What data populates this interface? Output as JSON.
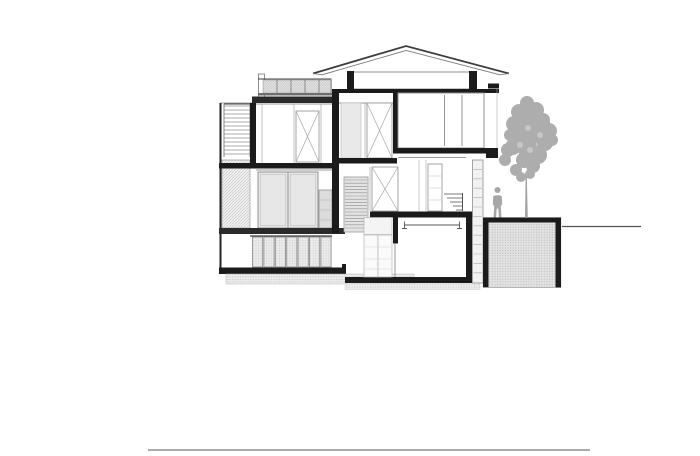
{
  "page": {
    "background": "#ffffff"
  },
  "colors": {
    "paper": "#ffffff",
    "ink": "#1b1b1b",
    "slab": "#2a2a2a",
    "dark": "#3d3d3d",
    "mid": "#7a7a7a",
    "light": "#a9a9a9",
    "frame": "#8f8f8f",
    "panel": "#e7e7e7",
    "panel-light": "#f2f2f2",
    "hatch-bg": "#ededed",
    "hatch-line": "#c3c3c3",
    "ground-bg": "#e2e2e2",
    "ground-dot": "#b7b7b7",
    "silhouette": "#a7a7a7",
    "ground-line": "#555555",
    "rule": "#8f8f8f"
  },
  "drawing": {
    "type": "architectural-section",
    "elements": [
      "hipped-roof",
      "clerestory-band",
      "roof-terrace-railing",
      "terrace-slab",
      "external-stair",
      "stair-balustrade-hatch",
      "boundary-wall",
      "second-floor-room",
      "x-braced-closet-door",
      "floor-slab",
      "sliding-glass-doors",
      "narrow-door-panel",
      "ground-floor-folding-doors",
      "foundation-base",
      "under-slab-hatch",
      "upper-room",
      "louvered-screen",
      "x-braced-door-upper",
      "x-braced-door-middle",
      "interior-door",
      "interior-stairs",
      "facade-shutter-column",
      "lower-bedroom",
      "curtain-rail",
      "bedroom-closet",
      "retaining-ground-block",
      "ground-line",
      "person-silhouette",
      "tree-silhouette",
      "site-baseline"
    ]
  }
}
